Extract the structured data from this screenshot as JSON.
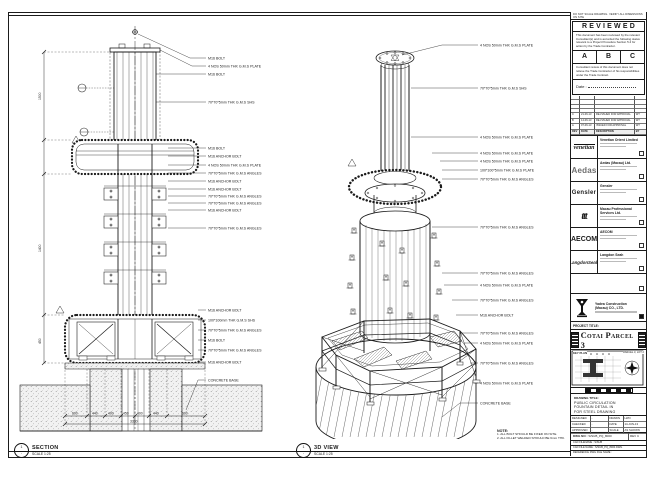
{
  "sheet": {
    "left_view": {
      "bubble_top": "1",
      "bubble_bottom": "-",
      "title": "SECTION",
      "scale": "SCALE 1:25",
      "callouts": [
        "M16 BOLT",
        "4 NOS 50mm THK G.M.S PLATE",
        "M16 BOLT",
        "70*70*5mm THK G.M.S SHS",
        "M16 BOLT",
        "M16 ANCHOR BOLT",
        "4 NOS 50mm THK G.M.S PLATE",
        "70*70*5mm THK G.M.S ANGLES",
        "M16 ANCHOR BOLT",
        "M16 ANCHOR BOLT",
        "70*70*5mm THK G.M.S ANGLES",
        "70*70*5mm THK G.M.S ANGLES",
        "M16 ANCHOR BOLT",
        "70*70*5mm THK G.M.S ANGLES",
        "M16 ANCHOR BOLT",
        "100*100mm THK G.M.S SHS",
        "70*70*5mm THK G.M.S ANGLES",
        "M16 BOLT",
        "70*70*5mm THK G.M.S ANGLES",
        "M16 ANCHOR BOLT",
        "CONCRETE BASE"
      ],
      "dims_left": [
        "1500",
        "1400",
        "450"
      ],
      "dims_bottom": [
        "600",
        "440",
        "400",
        "450",
        "400",
        "440",
        "600"
      ],
      "dim_total": "3330"
    },
    "right_view": {
      "title": "3D VIEW",
      "scale": "SCALE 1:25",
      "callouts": [
        "4 NOS 50mm THK G.M.S PLATE",
        "70*70*5mm THK G.M.S SHS",
        "4 NOS 50mm THK G.M.S PLATE",
        "4 NOS 50mm THK G.M.S PLATE",
        "4 NOS 50mm THK G.M.S PLATE",
        "100*100*5mm THK G.M.S PLATE",
        "70*70*5mm THK G.M.S ANGLES",
        "70*70*5mm THK G.M.S ANGLES",
        "70*70*5mm THK G.M.S ANGLES",
        "4 NOS 50mm THK G.M.S PLATE",
        "70*70*5mm THK G.M.S ANGLES",
        "M16 ANCHOR BOLT",
        "70*70*5mm THK G.M.S ANGLES",
        "4 NOS 50mm THK G.M.S PLATE",
        "70*70*5mm THK G.M.S ANGLES",
        "4 NOS 50mm THK G.M.S PLATE",
        "CONCRETE BASE"
      ],
      "note_heading": "NOTE:",
      "note_lines": [
        "1. ALL BOLT SHOULD BE FIXED ON SITE.",
        "2. ALL FILLET WELDED SHOULD BE 6mm THK."
      ]
    },
    "title_block": {
      "top_note": "DO NOT SCALE DRAWING. VERIFY ALL DIMENSIONS ON SITE",
      "reviewed": {
        "title": "REVIEWED",
        "para1": "This document has been reviewed by the relevant Consultant(s) and is accorded the following status relevant to a Project Procedure Section 5.4 for action by the Trade Contractor.",
        "boxes": [
          "A",
          "B",
          "C"
        ],
        "para2": "Consultant review of this document does not relieve the Trade Contractor of his responsibilities under the Trade Contract.",
        "date_label": "Date :"
      },
      "revisions": {
        "header": [
          "REV",
          "DATE",
          "DESCRIPTION",
          "BY"
        ],
        "rows": [
          [
            "C",
            "21-06-13",
            "RE-ISSUED FOR APPROVAL",
            "WT"
          ],
          [
            "B",
            "14-06-13",
            "RE-ISSUED FOR APPROVAL",
            "WT"
          ],
          [
            "A",
            "07-06-13",
            "ISSUED FOR APPROVAL",
            "WT"
          ]
        ]
      },
      "consultants": [
        {
          "logo": "venetian",
          "name": "Venetian Orient Limited"
        },
        {
          "logo": "Aedas",
          "name": "Aedas (Macau) Ltd."
        },
        {
          "logo": "Gensler",
          "name": "Gensler"
        },
        {
          "logo": "ttt",
          "name": "Macau Professional Services Ltd."
        },
        {
          "logo": "AECOM",
          "name": "AECOM"
        },
        {
          "logo": "LangdonSeah",
          "name": "Langdon Seah"
        }
      ],
      "contractor": {
        "name_line1": "Yadea Construction",
        "name_line2": "(Macau) CO., LTD."
      },
      "project_title_label": "PROJECT TITLE:",
      "project_title": "Cotai Parcel 3",
      "key_plan": {
        "label": "KEY PLAN",
        "right_label": "PARCEL 3, LOT 2"
      },
      "drawing_title_label": "DRAWING TITLE:",
      "drawing_title_lines": [
        "PUBLIC CIRCULATION",
        "FOUNTAIN DETAIL IN",
        "FOR STEEL DRAWING"
      ],
      "fields": {
        "rows": [
          [
            "DESIGNED",
            "-",
            "DRAWN",
            "LWO"
          ],
          [
            "CHECKED",
            "-",
            "DATE",
            "14-JUN-13"
          ],
          [
            "APPROVED",
            "-",
            "SCALE",
            "AS SHOWN"
          ]
        ]
      },
      "dwg": {
        "label": "DWG NO :",
        "number": "S/SUB_PQ_8000",
        "rev": "REV  C"
      },
      "cad_rows": [
        "CAD FILENAME : S/SUB",
        "CAD FILE NAME : S/SUB_PQ_8000.DWG",
        "REFERENCE DWG FILE NAME :"
      ]
    }
  }
}
